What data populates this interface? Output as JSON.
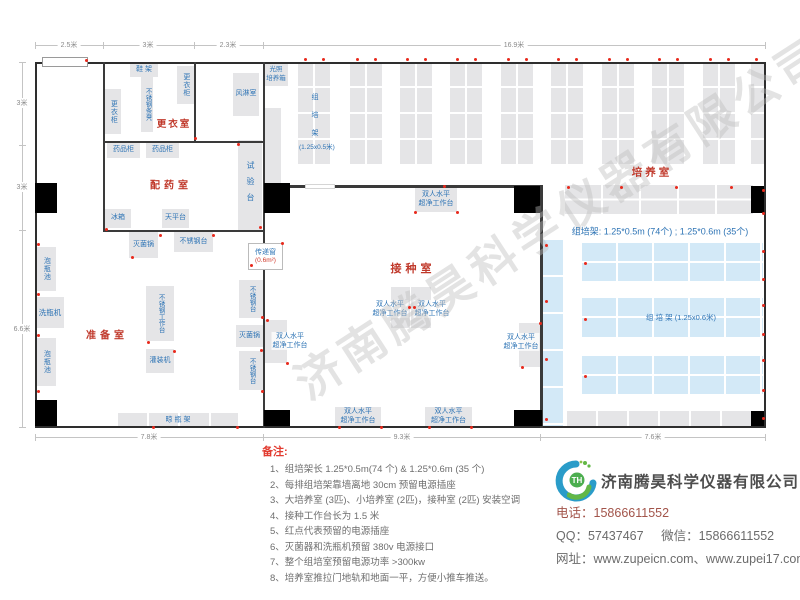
{
  "watermark": "济南腾昊科学仪器有限公司",
  "dims": {
    "top": [
      "2.5米",
      "3米",
      "2.3米",
      "16.9米"
    ],
    "left": [
      "3米",
      "3米",
      "6.6米"
    ],
    "bottom": [
      "7.8米",
      "9.3米",
      "7.6米"
    ]
  },
  "rooms": {
    "changing": "更衣室",
    "dispensing": "配药室",
    "prep": "准备室",
    "inoculation": "接种室",
    "culture": "培养室"
  },
  "equipment": {
    "shoe_rack": "鞋 架",
    "wardrobe": "更衣柜",
    "steel_bench_seat": "不锈钢条凳",
    "air_shower": "风淋室",
    "light_incubator": "光照\n培养箱",
    "medicine_cabinet": "药品柜",
    "fridge": "冰箱",
    "balance_table": "天平台",
    "test_bench": "试验台",
    "bottle_soak_pool": "泡瓶池",
    "bottle_washer": "洗瓶机",
    "sterilizer": "灭菌锅",
    "steel_table": "不锈钢台",
    "steel_worktable": "不锈钢工作台",
    "filling_machine": "灌装机",
    "bottle_drying_rack": "晾  瓶  架",
    "transfer_window": "传递窗",
    "transfer_window_size": "(0.6m²)",
    "clean_bench": "双人水平\n超净工作台"
  },
  "culture": {
    "rack_chars": "组\n培\n架",
    "rack_size": "(1.25x0.5米)",
    "spec": "组培架: 1.25*0.5m (74个) ; 1.25*0.6m (35个)",
    "blue_rack_label": "组  培  架 (1.25x0.6米)"
  },
  "notes": {
    "title": "备注:",
    "items": [
      "1、组培架长 1.25*0.5m(74 个) & 1.25*0.6m (35 个)",
      "2、每排组培架靠墙离地 30cm 预留电源插座",
      "3、大培养室 (3匹)、小培养室 (2匹)，接种室 (2匹) 安装空调",
      "4、接种工作台长为 1.5 米",
      "5、红点代表预留的电源插座",
      "6、灭菌器和洗瓶机预留 380v 电源接口",
      "7、整个组培室预留电源功率 >300kw",
      "8、培养室推拉门地轨和地面一平，方便小推车推送。"
    ]
  },
  "company": {
    "name": "济南腾昊科学仪器有限公司",
    "logo_text": "TH",
    "phone_label": "电话：",
    "phone": "15866611552",
    "qq_label": "QQ：",
    "qq": "57437467",
    "wechat_label": "微信：",
    "wechat": "15866611552",
    "web_label": "网址：",
    "web": "www.zupeicn.com、www.zupei17.com"
  },
  "colors": {
    "room_label_red": "#c0392b",
    "equipment_blue": "#2e74b5",
    "rack_blue": "#d3e9f7",
    "socket_dot_red": "#e8291c"
  }
}
